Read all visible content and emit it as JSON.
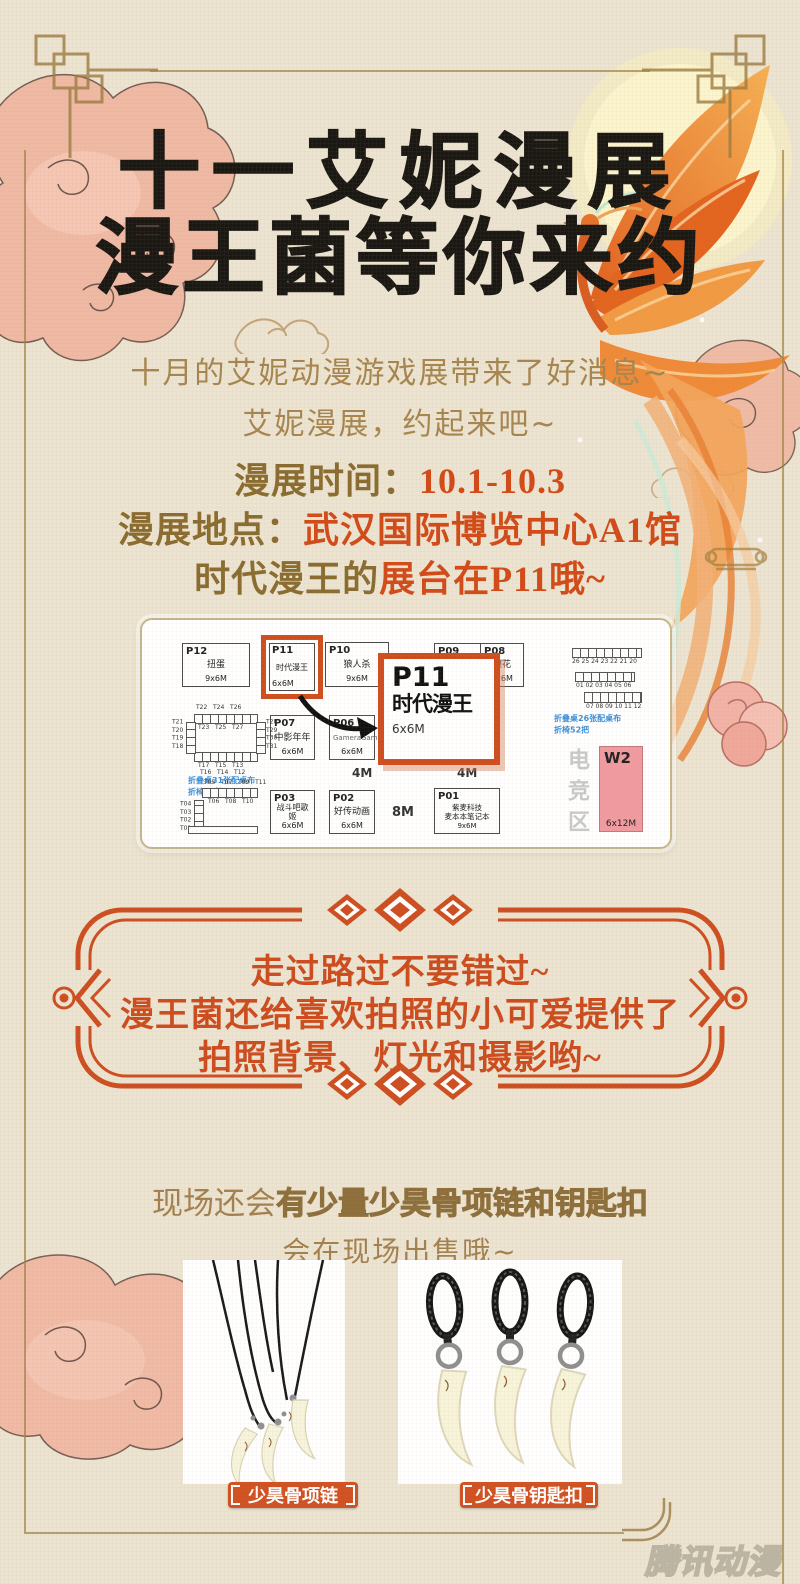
{
  "poster": {
    "title_line1": "十一艾妮漫展",
    "title_line2": "漫王菌等你来约",
    "intro_line1": "十月的艾妮动漫游戏展带来了好消息~",
    "intro_line2": "艾妮漫展，约起来吧~",
    "info": {
      "time_label": "漫展时间：",
      "time_value": "10.1-10.3",
      "place_label": "漫展地点：",
      "place_value": "武汉国际博览中心A1馆",
      "booth_line_prefix": "时代漫王的",
      "booth_line_highlight": "展台在P11哦~"
    },
    "highlight_frame": {
      "line1": "走过路过不要错过~",
      "line2": "漫王菌还给喜欢拍照的小可爱提供了",
      "line3": "拍照背景、灯光和摄影哟~"
    },
    "merch": {
      "line1_normal": "现场还会",
      "line1_bold": "有少量少昊骨项链和钥匙扣",
      "line2": "会在现场出售哦~",
      "label_necklace": "少昊骨项链",
      "label_keychain": "少昊骨钥匙扣"
    },
    "watermark": "腾讯动漫"
  },
  "floor_plan": {
    "booths": {
      "p12": {
        "id": "P12",
        "name": "扭蛋",
        "size": "9x6M"
      },
      "p11": {
        "id": "P11",
        "name": "时代漫王",
        "size": "6x6M"
      },
      "p10": {
        "id": "P10",
        "name": "狼人杀",
        "size": "9x6M"
      },
      "p09": {
        "id": "P09"
      },
      "p08": {
        "id": "P08",
        "name": "镜花",
        "size": "9x6M"
      },
      "p07": {
        "id": "P07",
        "name": "中影年年",
        "size": "6x6M"
      },
      "p06": {
        "id": "P06",
        "name": "GameraGame",
        "size": "6x6M"
      },
      "p03": {
        "id": "P03",
        "name": "战斗吧歌姬",
        "size": "6x6M"
      },
      "p02": {
        "id": "P02",
        "name": "好传动画",
        "size": "6x6M"
      },
      "p01": {
        "id": "P01",
        "name": "紫麦科技\n麦本本笔记本",
        "size": "9x6M"
      }
    },
    "callout": {
      "id": "P11",
      "name": "时代漫王",
      "size": "6x6M"
    },
    "tables_a": {
      "top_row": "T22   T24   T26",
      "inner_top_row": "T23   T25   T27",
      "left_col": "T21\nT20\nT19\nT18",
      "right_col": "T28\nT29\nT30\nT31",
      "bottom_row1": "T17   T15   T13",
      "bottom_row2": "T16   T14   T12",
      "note": "折叠桌31张配桌布\n折椅62把"
    },
    "tables_b": {
      "top_row": "T05   T07   T09   T11",
      "bottom_row": "T06   T08   T10",
      "left_col": "T04\nT03\nT02\nT01"
    },
    "tables_right": {
      "row1_label": "26 25 24 23 22 21 20",
      "row2_label": "01 02 03 04 05 06",
      "row3_label": "07 08 09 10 11 12",
      "note": "折叠桌26张配桌布\n折椅52把"
    },
    "dims": {
      "d4m_left": "4M",
      "d4m_right": "4M",
      "d8m": "8M"
    },
    "esports_label": "电竞区",
    "w2": {
      "id": "W2",
      "size": "6x12M"
    }
  },
  "colors": {
    "accent_orange": "#cc4c1e",
    "info_red": "#d24a18",
    "text_brown": "#a28050",
    "note_blue": "#3d8fd8",
    "w2_pink": "#f19ba1"
  }
}
